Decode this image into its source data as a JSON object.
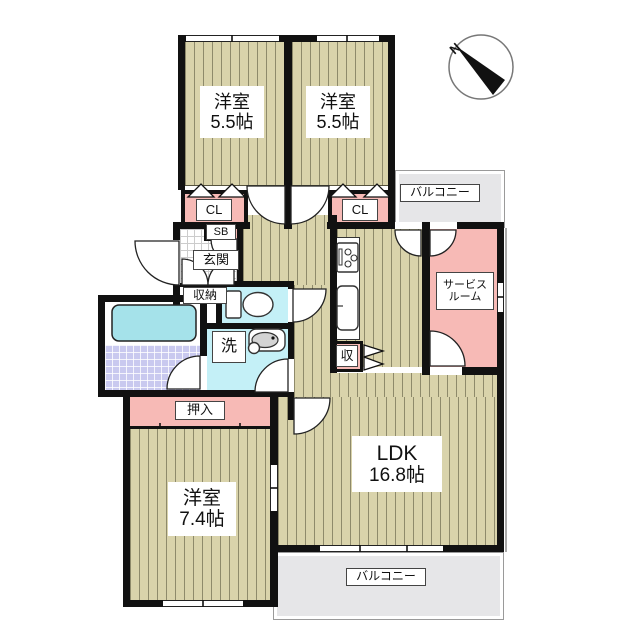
{
  "plan_title": "apartment-floor-plan",
  "compass": {
    "north_label": "N"
  },
  "rooms": {
    "bedroom1": {
      "name": "洋室",
      "size": "5.5帖"
    },
    "bedroom2": {
      "name": "洋室",
      "size": "5.5帖"
    },
    "bedroom3": {
      "name": "洋室",
      "size": "7.4帖"
    },
    "ldk": {
      "name": "LDK",
      "size": "16.8帖"
    },
    "service_room": {
      "line1": "サービス",
      "line2": "ルーム"
    },
    "entrance": {
      "label": "玄関"
    },
    "storage": {
      "label": "収納"
    },
    "shoe_box": {
      "label": "SB"
    },
    "closet1": {
      "label": "CL"
    },
    "closet2": {
      "label": "CL"
    },
    "washroom": {
      "label": "洗"
    },
    "oshiire": {
      "label": "押入"
    },
    "pantry": {
      "label": "収"
    },
    "balcony_top": {
      "label": "バルコニー"
    },
    "balcony_bottom": {
      "label": "バルコニー"
    }
  },
  "colors": {
    "wall": "#111111",
    "floor": "#d9d3ab",
    "floor_stripe": "#8e8a6b",
    "closet_pink": "#f7bab6",
    "wet_area_cyan": "#c4f0f7",
    "bathtub": "#a5e2ea",
    "bath_tile": "#c9c9ef",
    "balcony_gray": "#e6e6e8"
  }
}
